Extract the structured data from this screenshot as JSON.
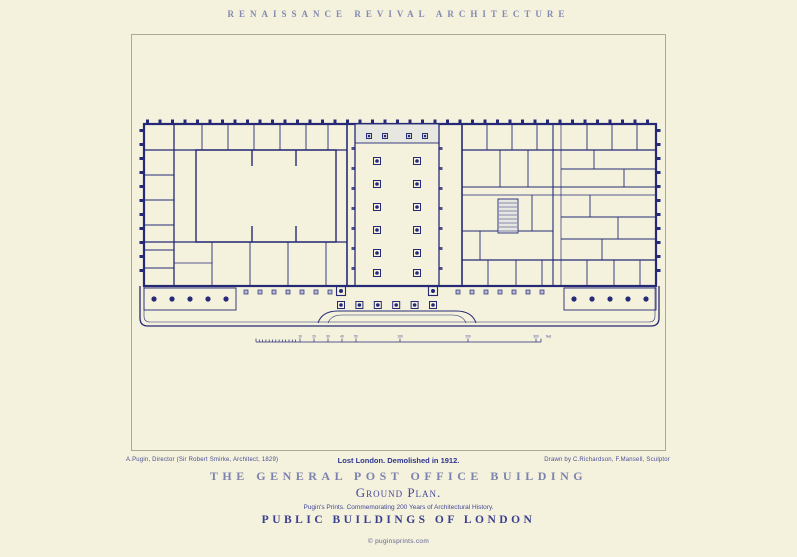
{
  "poster": {
    "series_title": "RENAISSANCE REVIVAL ARCHITECTURE",
    "captions": {
      "left": "A.Pugin, Director (Sir Robert Smirke, Architect, 1829)",
      "center": "Lost London. Demolished in 1912.",
      "right": "Drawn by C.Richardson, F.Mansell, Sculptor"
    },
    "main_title": "THE GENERAL POST OFFICE BUILDING",
    "plan_label": "Ground Plan.",
    "commemoration": "Pugin's Prints. Commemorating 200 Years of Architectural History.",
    "collection_title": "PUBLIC BUILDINGS OF LONDON",
    "footer": "© puginsprints.com",
    "scale_bar": {
      "tick_labels": [
        "10",
        "20",
        "30",
        "40",
        "50",
        "100",
        "200",
        "300"
      ],
      "unit_label": "feet"
    },
    "colors": {
      "paper": "#f4f1dc",
      "ink": "#262a76",
      "muted_title": "#8289b4",
      "accent": "#2f3590",
      "frame_line": "#aaaa9b"
    }
  }
}
